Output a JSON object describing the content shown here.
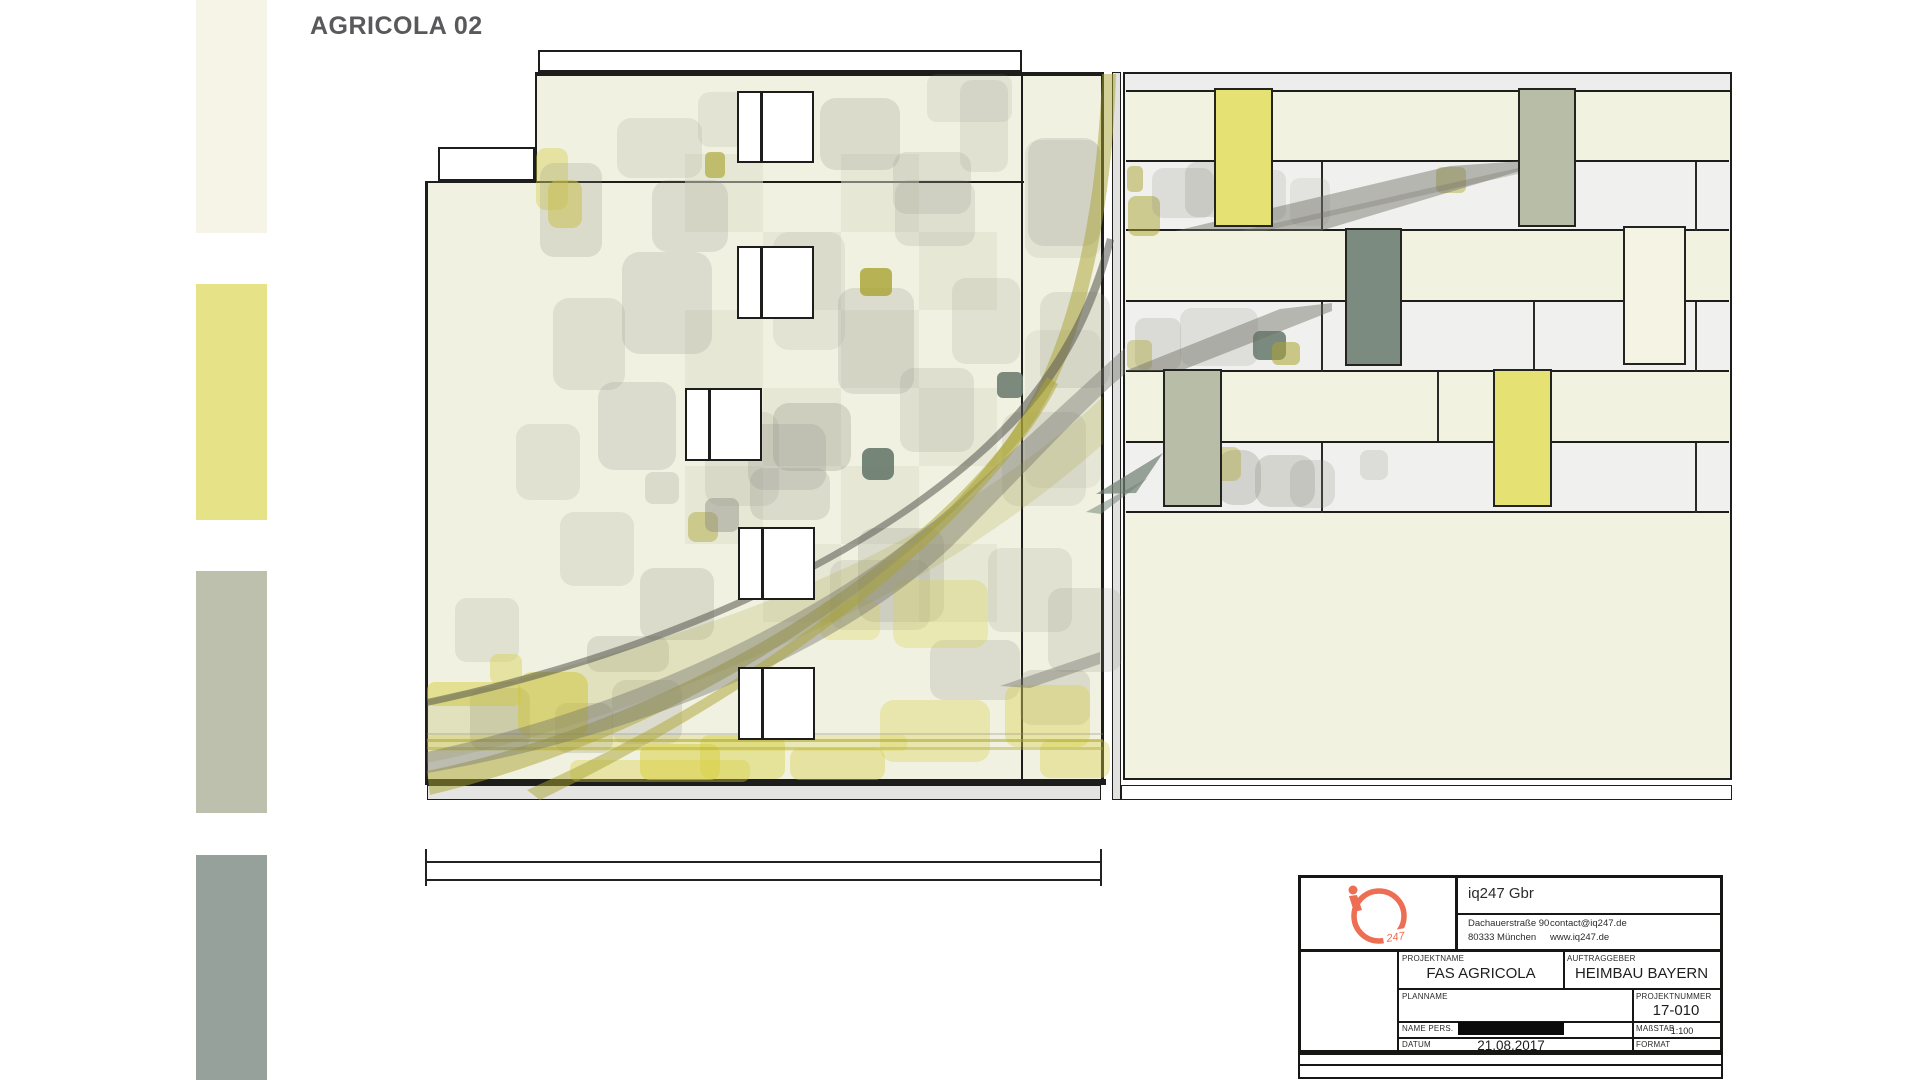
{
  "title": "AGRICOLA 02",
  "palette_note": "material swatch legend, top to bottom",
  "swatches": [
    {
      "name": "cream",
      "color": "#f5f4e6",
      "y": 0,
      "h": 233
    },
    {
      "name": "yellow",
      "color": "#e6e287",
      "y": 284,
      "h": 236
    },
    {
      "name": "sage",
      "color": "#bcc0ad",
      "y": 571,
      "h": 242
    },
    {
      "name": "slate-green",
      "color": "#95a19a",
      "y": 855,
      "h": 225
    }
  ],
  "drawing": {
    "rects": [
      [
        538,
        50,
        484,
        22,
        "#ffffff",
        2.5
      ],
      [
        535,
        72,
        568,
        110,
        "#f1f1e1",
        0
      ],
      [
        425,
        182,
        678,
        597,
        "#f1f1e1",
        0
      ],
      [
        535,
        72,
        568,
        4,
        "#1d1d1b",
        0
      ],
      [
        535,
        74,
        2,
        107,
        "#1d1d1b",
        0
      ],
      [
        438,
        147,
        97,
        34,
        "#ffffff",
        2.5
      ],
      [
        425,
        181,
        599,
        2,
        "#1d1d1b",
        0
      ],
      [
        425,
        182,
        3,
        597,
        "#1d1d1b",
        0
      ],
      [
        1021,
        76,
        2,
        703,
        "#1d1d1b",
        0
      ],
      [
        1101,
        72,
        3,
        707,
        "#1d1d1b",
        0
      ],
      [
        425,
        779,
        681,
        6,
        "#1d1d1b",
        0
      ],
      [
        427,
        785,
        674,
        15,
        "#e4e4e2",
        1.5
      ],
      [
        1112,
        72,
        9,
        728,
        "#e1e1df",
        1.5
      ],
      [
        1123,
        72,
        609,
        708,
        "#f2f2e1",
        2.5
      ],
      [
        1126,
        74,
        604,
        18,
        "#ededee",
        0
      ],
      [
        1126,
        90,
        604,
        2,
        "#1d1d1b",
        0
      ],
      [
        1126,
        162,
        603,
        69,
        "#f0f0ee",
        0
      ],
      [
        1126,
        302,
        603,
        70,
        "#f0f0ee",
        0
      ],
      [
        1126,
        443,
        603,
        70,
        "#f0f0ee",
        0
      ],
      [
        1126,
        160,
        603,
        2,
        "#1d1d1b",
        0
      ],
      [
        1126,
        229,
        603,
        2,
        "#1d1d1b",
        0
      ],
      [
        1126,
        300,
        603,
        2,
        "#1d1d1b",
        0
      ],
      [
        1126,
        370,
        603,
        2,
        "#1d1d1b",
        0
      ],
      [
        1126,
        441,
        603,
        2,
        "#1d1d1b",
        0
      ],
      [
        1126,
        511,
        603,
        2,
        "#1d1d1b",
        0
      ],
      [
        1321,
        162,
        2,
        69,
        "#2a2a26",
        0
      ],
      [
        1695,
        162,
        2,
        69,
        "#2a2a26",
        0
      ],
      [
        1321,
        302,
        2,
        70,
        "#2a2a26",
        0
      ],
      [
        1533,
        302,
        2,
        70,
        "#2a2a26",
        0
      ],
      [
        1695,
        302,
        2,
        70,
        "#2a2a26",
        0
      ],
      [
        1437,
        372,
        2,
        69,
        "#2a2a26",
        0
      ],
      [
        1321,
        443,
        2,
        70,
        "#2a2a26",
        0
      ],
      [
        1695,
        443,
        2,
        70,
        "#2a2a26",
        0
      ],
      [
        1121,
        785,
        611,
        15,
        "#ffffff",
        1.5
      ],
      [
        427,
        861,
        675,
        2,
        "#222220",
        0
      ],
      [
        427,
        879,
        675,
        2,
        "#222220",
        0
      ],
      [
        425,
        849,
        2,
        37,
        "#222220",
        0
      ],
      [
        1100,
        849,
        2,
        37,
        "#222220",
        0
      ]
    ],
    "windows": [
      [
        737,
        91,
        77,
        72
      ],
      [
        737,
        246,
        77,
        73
      ],
      [
        685,
        388,
        77,
        73
      ],
      [
        738,
        527,
        77,
        73
      ],
      [
        738,
        667,
        77,
        73
      ]
    ],
    "boards": [
      [
        1214,
        88,
        59,
        139,
        "#e5e173"
      ],
      [
        1518,
        88,
        58,
        139,
        "#b8bda7"
      ],
      [
        1345,
        228,
        57,
        138,
        "#7b8b80"
      ],
      [
        1623,
        226,
        63,
        139,
        "#f4f3e4"
      ],
      [
        1163,
        369,
        59,
        138,
        "#b8bda7"
      ],
      [
        1493,
        369,
        59,
        138,
        "#e5e173"
      ]
    ],
    "patch_colors": {
      "g": "#8e8e84",
      "y": "#d8d044",
      "o": "#a9a431",
      "ds": "#6e7e71",
      "ck": "#dedecb",
      "lg": "#cfcfc6"
    },
    "patches": [
      [
        685,
        154,
        78,
        78,
        "ck",
        0.5,
        0
      ],
      [
        841,
        154,
        78,
        78,
        "ck",
        0.5,
        0
      ],
      [
        763,
        232,
        78,
        78,
        "ck",
        0.5,
        0
      ],
      [
        919,
        232,
        78,
        78,
        "ck",
        0.5,
        0
      ],
      [
        685,
        310,
        78,
        78,
        "ck",
        0.5,
        0
      ],
      [
        841,
        310,
        78,
        78,
        "ck",
        0.5,
        0
      ],
      [
        763,
        388,
        78,
        78,
        "ck",
        0.5,
        0
      ],
      [
        919,
        388,
        78,
        78,
        "ck",
        0.5,
        0
      ],
      [
        685,
        466,
        78,
        78,
        "ck",
        0.5,
        0
      ],
      [
        841,
        466,
        78,
        78,
        "ck",
        0.5,
        0
      ],
      [
        763,
        544,
        78,
        78,
        "ck",
        0.5,
        0
      ],
      [
        919,
        544,
        78,
        78,
        "ck",
        0.5,
        0
      ],
      [
        617,
        118,
        85,
        60,
        "g",
        0.16,
        14
      ],
      [
        698,
        92,
        60,
        55,
        "g",
        0.13,
        12
      ],
      [
        820,
        98,
        80,
        72,
        "g",
        0.22,
        16
      ],
      [
        927,
        74,
        85,
        48,
        "g",
        0.14,
        10
      ],
      [
        893,
        152,
        78,
        62,
        "g",
        0.18,
        14
      ],
      [
        1028,
        138,
        72,
        108,
        "g",
        0.2,
        16
      ],
      [
        960,
        80,
        48,
        92,
        "g",
        0.16,
        12
      ],
      [
        536,
        148,
        32,
        62,
        "y",
        0.4,
        10
      ],
      [
        548,
        180,
        34,
        48,
        "y",
        0.55,
        10
      ],
      [
        540,
        163,
        62,
        94,
        "g",
        0.22,
        14
      ],
      [
        553,
        298,
        72,
        92,
        "g",
        0.18,
        16
      ],
      [
        622,
        252,
        90,
        102,
        "g",
        0.2,
        18
      ],
      [
        652,
        180,
        76,
        72,
        "g",
        0.2,
        16
      ],
      [
        773,
        232,
        72,
        118,
        "g",
        0.13,
        16
      ],
      [
        838,
        288,
        76,
        106,
        "g",
        0.2,
        16
      ],
      [
        952,
        278,
        68,
        86,
        "g",
        0.16,
        14
      ],
      [
        1040,
        292,
        70,
        96,
        "g",
        0.18,
        16
      ],
      [
        895,
        180,
        80,
        66,
        "g",
        0.18,
        14
      ],
      [
        598,
        382,
        78,
        88,
        "g",
        0.2,
        16
      ],
      [
        516,
        424,
        64,
        76,
        "g",
        0.16,
        14
      ],
      [
        705,
        412,
        74,
        94,
        "g",
        0.16,
        16
      ],
      [
        900,
        368,
        74,
        84,
        "g",
        0.18,
        14
      ],
      [
        1002,
        412,
        84,
        94,
        "g",
        0.16,
        16
      ],
      [
        773,
        403,
        78,
        68,
        "g",
        0.28,
        16
      ],
      [
        748,
        424,
        78,
        66,
        "g",
        0.22,
        16
      ],
      [
        750,
        468,
        80,
        52,
        "g",
        0.22,
        14
      ],
      [
        645,
        472,
        34,
        32,
        "g",
        0.22,
        8
      ],
      [
        560,
        512,
        74,
        74,
        "g",
        0.16,
        14
      ],
      [
        858,
        528,
        86,
        94,
        "g",
        0.2,
        16
      ],
      [
        640,
        568,
        74,
        72,
        "g",
        0.22,
        14
      ],
      [
        988,
        548,
        84,
        84,
        "g",
        0.16,
        14
      ],
      [
        455,
        598,
        64,
        64,
        "g",
        0.16,
        12
      ],
      [
        1048,
        588,
        74,
        84,
        "g",
        0.18,
        14
      ],
      [
        587,
        636,
        82,
        36,
        "g",
        0.22,
        12
      ],
      [
        612,
        680,
        70,
        64,
        "g",
        0.2,
        14
      ],
      [
        830,
        560,
        100,
        70,
        "g",
        0.18,
        14
      ],
      [
        930,
        640,
        90,
        60,
        "g",
        0.2,
        14
      ],
      [
        1020,
        670,
        70,
        55,
        "g",
        0.22,
        12
      ],
      [
        470,
        688,
        60,
        62,
        "g",
        0.28,
        12
      ],
      [
        555,
        703,
        58,
        50,
        "g",
        0.25,
        12
      ],
      [
        862,
        448,
        32,
        32,
        "ds",
        0.95,
        8
      ],
      [
        997,
        372,
        26,
        26,
        "ds",
        0.9,
        6
      ],
      [
        860,
        268,
        32,
        28,
        "o",
        0.8,
        6
      ],
      [
        705,
        152,
        20,
        26,
        "o",
        0.65,
        5
      ],
      [
        688,
        512,
        30,
        30,
        "o",
        0.45,
        8
      ],
      [
        705,
        498,
        34,
        34,
        "g",
        0.45,
        8
      ],
      [
        427,
        682,
        94,
        24,
        "y",
        0.5,
        8
      ],
      [
        518,
        672,
        70,
        66,
        "y",
        0.55,
        14
      ],
      [
        490,
        654,
        32,
        30,
        "y",
        0.4,
        8
      ],
      [
        427,
        735,
        480,
        16,
        "y",
        0.28,
        6
      ],
      [
        640,
        744,
        80,
        36,
        "y",
        0.55,
        10
      ],
      [
        700,
        735,
        85,
        44,
        "y",
        0.45,
        10
      ],
      [
        790,
        748,
        95,
        32,
        "y",
        0.4,
        10
      ],
      [
        880,
        700,
        110,
        62,
        "y",
        0.33,
        14
      ],
      [
        893,
        580,
        95,
        68,
        "y",
        0.3,
        14
      ],
      [
        1005,
        685,
        85,
        62,
        "y",
        0.38,
        12
      ],
      [
        1040,
        740,
        70,
        38,
        "y",
        0.38,
        10
      ],
      [
        570,
        760,
        180,
        22,
        "y",
        0.38,
        8
      ],
      [
        820,
        600,
        60,
        40,
        "y",
        0.28,
        10
      ],
      [
        427,
        739,
        676,
        3,
        "o",
        0.55,
        0
      ],
      [
        427,
        747,
        676,
        3,
        "o",
        0.4,
        0
      ],
      [
        427,
        733,
        676,
        2,
        "g",
        0.3,
        0
      ],
      [
        1025,
        140,
        76,
        118,
        "g",
        0.14,
        14
      ],
      [
        1025,
        330,
        76,
        158,
        "g",
        0.1,
        14
      ],
      [
        1127,
        166,
        16,
        26,
        "o",
        0.5,
        5
      ],
      [
        1128,
        196,
        32,
        40,
        "o",
        0.5,
        8
      ],
      [
        1152,
        168,
        62,
        50,
        "g",
        0.2,
        12
      ],
      [
        1185,
        162,
        58,
        55,
        "g",
        0.22,
        12
      ],
      [
        1240,
        170,
        46,
        50,
        "g",
        0.18,
        10
      ],
      [
        1436,
        167,
        30,
        26,
        "o",
        0.45,
        6
      ],
      [
        1290,
        178,
        40,
        48,
        "g",
        0.14,
        10
      ],
      [
        1135,
        318,
        46,
        52,
        "g",
        0.22,
        10
      ],
      [
        1180,
        308,
        78,
        58,
        "g",
        0.18,
        12
      ],
      [
        1253,
        331,
        33,
        29,
        "ds",
        0.9,
        7
      ],
      [
        1272,
        342,
        28,
        23,
        "o",
        0.55,
        6
      ],
      [
        1127,
        340,
        25,
        30,
        "o",
        0.4,
        6
      ],
      [
        1216,
        450,
        45,
        55,
        "g",
        0.3,
        18
      ],
      [
        1255,
        455,
        60,
        52,
        "g",
        0.28,
        16
      ],
      [
        1290,
        460,
        45,
        48,
        "g",
        0.22,
        14
      ],
      [
        1165,
        455,
        40,
        40,
        "g",
        0.3,
        10
      ],
      [
        1211,
        447,
        30,
        34,
        "o",
        0.4,
        8
      ],
      [
        1360,
        450,
        28,
        30,
        "g",
        0.2,
        8
      ]
    ],
    "ribbons": [
      {
        "d": "M430 795 C680 735 900 585 1020 440 C1090 355 1113 190 1116 74 L1102 74 C1098 195 1075 345 1006 441 C892 586 662 722 427 771 Z",
        "c": "#a9a431",
        "o": 0.5
      },
      {
        "d": "M427 700 C640 655 840 585 960 505 C1030 460 1080 420 1103 396 L1103 444 C1060 482 992 536 902 586 C762 662 582 731 427 763 Z",
        "c": "#a9a431",
        "o": 0.2
      },
      {
        "d": "M427 752 C660 700 850 600 970 490 C1050 417 1100 370 1125 348 L1125 374 C1086 406 1032 466 952 546 C842 651 642 736 427 773 Z",
        "c": "#6f6f66",
        "o": 0.4
      },
      {
        "d": "M427 706 C700 648 900 540 1010 430 C1068 372 1098 305 1114 240 L1107 238 C1090 302 1060 365 1002 426 C897 536 692 642 427 699 Z",
        "c": "#55554e",
        "o": 0.55
      },
      {
        "d": "M540 800 C700 722 852 622 950 522 C1000 472 1038 424 1058 384 L1047 377 C1022 422 986 472 936 522 C842 617 692 717 527 790 Z",
        "c": "#a9a431",
        "o": 0.5
      },
      {
        "d": "M1175 231 L1450 166 L1523 161 L1523 170 L1320 231 Z",
        "c": "#6f6f66",
        "o": 0.45
      },
      {
        "d": "M1240 231 L1518 168 L1518 174 L1264 231 Z",
        "c": "#6f6f66",
        "o": 0.3
      },
      {
        "d": "M1125 371 L1280 309 L1332 303 L1332 311 L1180 371 Z",
        "c": "#6f6f66",
        "o": 0.45
      },
      {
        "d": "M1096 494 L1163 453 L1136 493 Z",
        "c": "#6e7e71",
        "o": 0.7
      },
      {
        "d": "M1086 512 L1148 478 L1101 514 Z",
        "c": "#6e7e71",
        "o": 0.5
      },
      {
        "d": "M1000 686 L1100 652 L1100 664 L1030 688 Z",
        "c": "#6f6f66",
        "o": 0.4
      }
    ]
  },
  "title_block": {
    "company": "iq247 Gbr",
    "logo_247": "247",
    "address_line1": "Dachauerstraße 90",
    "address_line2": "80333 München",
    "email": "contact@iq247.de",
    "website": "www.iq247.de",
    "accent_color": "#ed6e52",
    "fields": {
      "projektname": {
        "label": "PROJEKTNAME",
        "value": "FAS AGRICOLA"
      },
      "auftraggeber": {
        "label": "AUFTRAGGEBER",
        "value": "HEIMBAU BAYERN"
      },
      "planname": {
        "label": "PLANNAME",
        "value": ""
      },
      "projektnummer": {
        "label": "PROJEKTNUMMER",
        "value": "17-010"
      },
      "name_pers": {
        "label": "NAME PERS.",
        "value": ""
      },
      "masstab": {
        "label": "MAßSTAB",
        "value": "1:100"
      },
      "datum": {
        "label": "DATUM",
        "value": "21.08.2017"
      },
      "format": {
        "label": "FORMAT",
        "value": ""
      }
    }
  }
}
